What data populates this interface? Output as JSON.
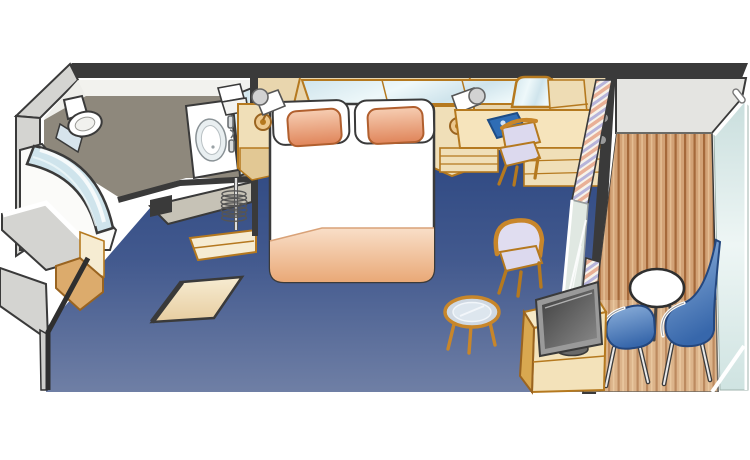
{
  "diagram": {
    "title": "Balcony stateroom cabin floor plan",
    "type": "cruise-cabin-isometric-floorplan",
    "rooms": [
      {
        "name": "bathroom",
        "items": [
          "toilet",
          "shower with curved glass door",
          "sink vanity",
          "mirror",
          "towels"
        ]
      },
      {
        "name": "entry",
        "items": [
          "closet with hanger rod",
          "open entrance door",
          "corridor cabinet"
        ]
      },
      {
        "name": "bedroom",
        "items": [
          "queen bed with two peach pillows",
          "two nightstands",
          "two wall reading lamps",
          "wall mirror strip",
          "desk with chair",
          "arched desk mirror",
          "blue guest book",
          "armchair",
          "round glass coffee table",
          "flat TV on cabinet",
          "striped curtain",
          "sliding glass door"
        ]
      },
      {
        "name": "balcony",
        "items": [
          "wood plank deck",
          "round white table",
          "two blue chairs",
          "glass railing",
          "partition wall"
        ]
      }
    ]
  },
  "colors": {
    "wall-dark": "#3a3a3a",
    "wall-gray": "#d4d4d1",
    "wall-gray-light": "#e4e4e1",
    "white": "#ffffff",
    "bath-floor": "#8e887c",
    "closet-gray": "#c6c2b6",
    "beige-light": "#f6ecd2",
    "beige": "#f0dfb8",
    "beige-deep": "#e9d6ae",
    "tan-trim": "#b5791f",
    "ochre": "#dcab6c",
    "carpet-top": "#24407c",
    "carpet-mid": "#42598e",
    "carpet-bottom": "#6f7fa5",
    "peach-light": "#f6cdb2",
    "peach-dark": "#e0855a",
    "book-blue": "#2f6db5",
    "lavender": "#dcd9ee",
    "glass-blue": "#cfe4ec",
    "glass-pale": "#eef8fa",
    "deck-base": "#d2a276",
    "deck-line": "#a5693a",
    "chair-blue-light": "#8fb2dc",
    "chair-blue-dark": "#3767ab",
    "curtain-pink": "#e9b096",
    "curtain-lavender": "#b7b4da",
    "curtain-cream": "#f7f3ea",
    "tv-gray": "#9a9a9a"
  }
}
